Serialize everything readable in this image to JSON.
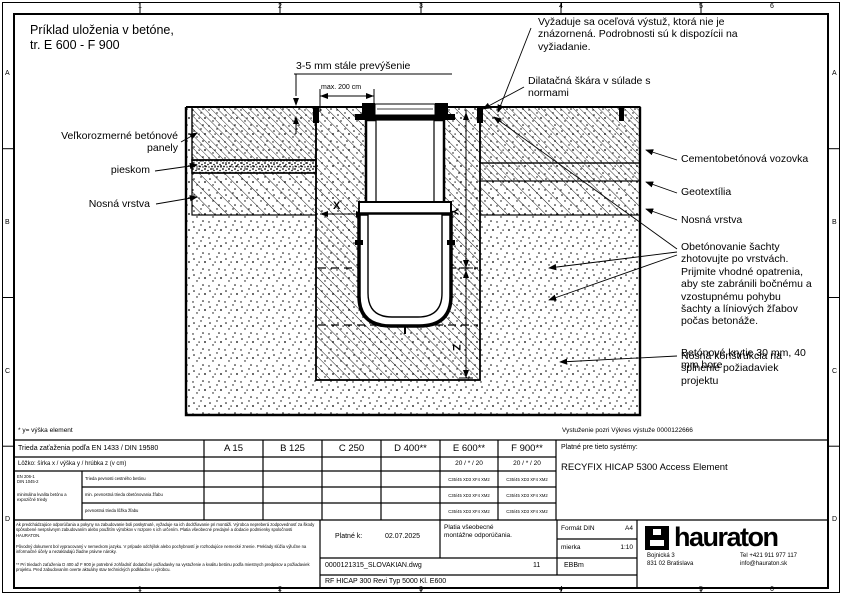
{
  "frame": {
    "columns": [
      "1",
      "2",
      "3",
      "4",
      "5",
      "6"
    ],
    "rows": [
      "A",
      "B",
      "C",
      "D"
    ]
  },
  "title": "Príklad uloženia v betóne,\ntr. E 600 - F 900",
  "annotations": {
    "top_dim": "3-5 mm stále prevýšenie",
    "max_dim": "max. 200 cm",
    "left_panels": "Veľkorozmerné betónové\npanely",
    "left_sand": "pieskom",
    "left_base": "Nosná vrstva",
    "steel_note": "Vyžaduje sa oceľová výstuž, ktorá nie je\nznázornená. Podrobnosti sú k dispozícii na\nvyžiadanie.",
    "joint_note": "Dilatačná škára v súlade s\nnormami",
    "right_road": "Cementobetónová vozovka",
    "right_geo": "Geotextília",
    "right_base": "Nosná vrstva",
    "encase_note": "Obetónovanie šachty\nzhotovujte po vrstvách.\nPrijmite vhodné opatrenia,\naby ste zabránili bočnému a\nvzostupnému pohybu\nšachty a líniových žľabov\npočas betonáže.",
    "overlap_a": "Betónové krytie 30 mm, 40\nmm hore",
    "overlap_b": "Nosná konštrukcia na\nsplnenie požiadaviek\nprojektu",
    "dim_x": "X",
    "dim_y": "Y",
    "dim_z": "Z",
    "footnote": "* y= výška element",
    "reinforcement_note": "Vystuženie pozri Výkres výstuže 0000122666"
  },
  "table": {
    "load_class_label": "Trieda zaťaženia podľa EN 1433 / DIN 19580",
    "classes": [
      "A 15",
      "B 125",
      "C 250",
      "D 400**",
      "E 600**",
      "F 900**"
    ],
    "bedding_label": "Lôžko: šírka x / výška y / hrúbka z (v cm)",
    "bedding_e": "20 / * / 20",
    "bedding_f": "20 / * / 20",
    "norm_label": "EN 206-1\nDIN 1045-2",
    "norm_sub": "minimálna kvalita betónu a expozičné triedy",
    "row1_label": "Trieda pevnosti cestného betónu",
    "row2_label": "min. pevnostná trieda obetónovania žľabu",
    "row3_label": "pevnostná trieda lôžka žľabu",
    "value": "C35/45 XD3 XF4 XM2",
    "systems_label": "Platné pre tieto systémy:",
    "systems_value": "RECYFIX HICAP 5300 Access Element"
  },
  "titleblock": {
    "valid_label": "Platné k:",
    "valid_date": "02.07.2025",
    "general_note": "Platia všeobecné\nmontážne odporúčania.",
    "format_label": "Formát DIN",
    "format_value": "A4",
    "scale_label": "mierka",
    "scale_value": "1:10",
    "file_name": "0000121315_SLOVAKIAN.dwg",
    "sheet_no": "11",
    "code": "EBBm",
    "drawing_title": "RF HICAP 300 Revi Typ 5000 Kl. E600",
    "company": {
      "name": "hauraton",
      "address1": "Bojnická 3",
      "address2": "831 02 Bratislava",
      "tel": "Tel +421 911 977 117",
      "email": "info@hauraton.sk"
    }
  },
  "fine_print": {
    "p1": "Ak predchádzajúce odporúčania a pokyny na zabudovanie boli poskytnuté, vyžaduje sa ich dodržiavanie pri montáži. Výrobca nepreberá zodpovednosť za škody spôsobené nesprávnym zabudovaním alebo použitím výrobkov v rozpore s ich určením. Platia všeobecné predajné a dodacie podmienky spoločnosti HAURATON.",
    "p2": "Pôvodný dokument bol vypracovaný v nemeckom jazyku. V prípade odchýlok alebo pochybností je rozhodujúce nemecké znenie. Preklady slúžia výlučne na informačné účely a nezakladajú žiadne právne nároky.",
    "p3": "** Pri triedach zaťaženia D 400 až F 900 je potrebné zohľadniť dodatočné požiadavky na vystuženie a kvalitu betónu podľa miestnych predpisov a požiadaviek projektu. Pred zabudovaním overte aktuálny stav technických podkladov u výrobcu."
  }
}
